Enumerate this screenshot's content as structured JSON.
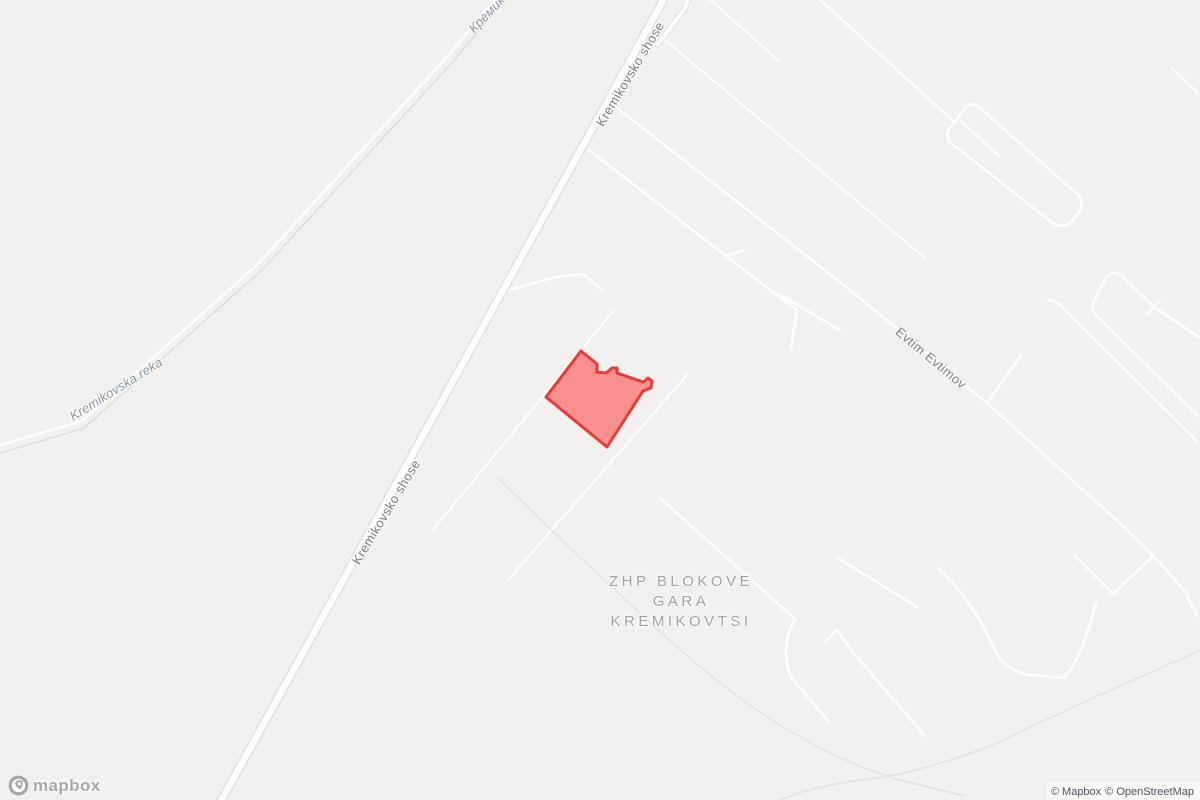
{
  "map": {
    "theme": {
      "background": "#f2f1ef",
      "road_fill": "#ffffff",
      "road_casing": "#e3e0dc",
      "faint_line": "#e3e1dd",
      "road_label_color": "#7e7e7e",
      "water_label_color": "#8a97a4",
      "place_label_color": "#a2a19f",
      "highlight_fill": "#fa8585",
      "highlight_stroke": "#e63c35"
    },
    "labels": {
      "road_main_top": "Kremikovsko shose",
      "road_main_mid": "Kremikovsko shose",
      "road_evtim": "Evtim Evtimov",
      "river_latin": "Kremikovska reka",
      "river_cyrillic": "Кремиковска река",
      "place_line1": "ZHP BLOKOVE",
      "place_line2": "GARA",
      "place_line3": "KREMIKOVTSI"
    },
    "highlight": {
      "points_svg": "581,351 597,364 597,372 606,373 612,368 617,368 617,373 643,382 648,378 652,381 651,388 643,391 607,447 546,397"
    }
  },
  "branding": {
    "logo_text": "mapbox"
  },
  "attribution": {
    "items": [
      "© Mapbox",
      "© OpenStreetMap"
    ]
  }
}
